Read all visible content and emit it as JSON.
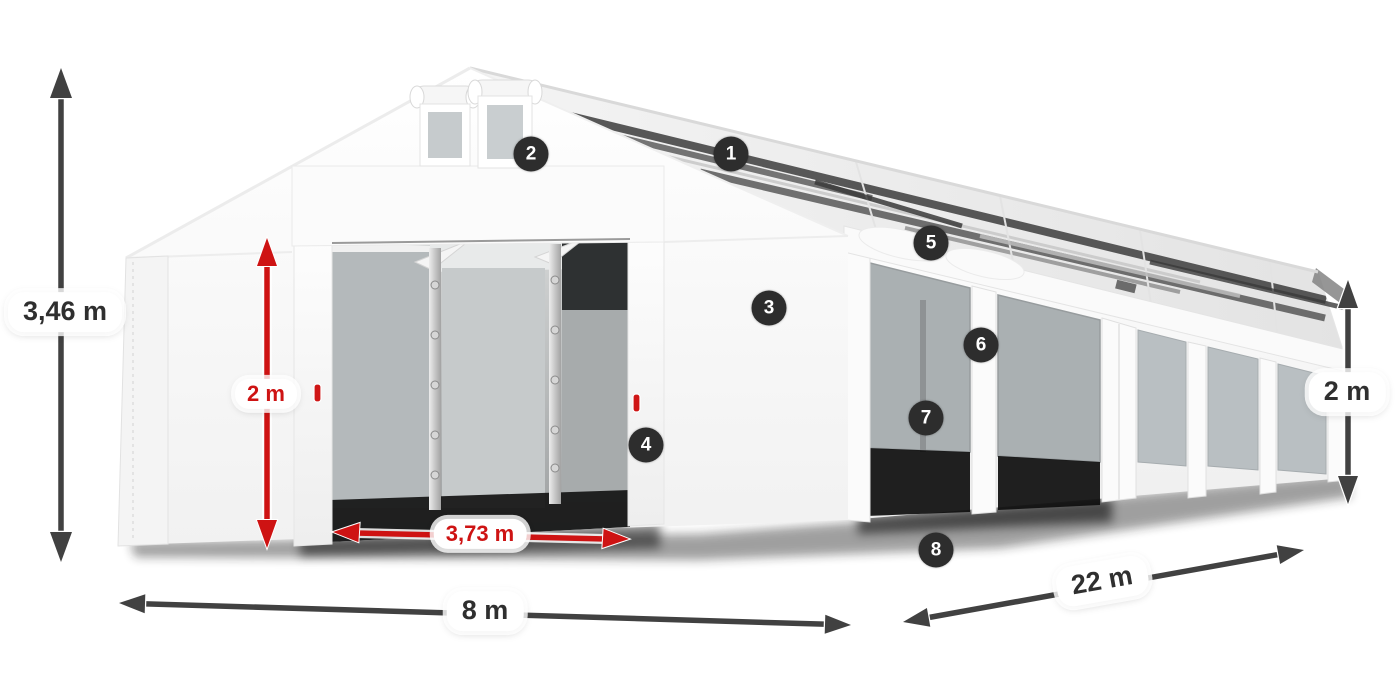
{
  "callouts": [
    {
      "number": "1"
    },
    {
      "number": "2"
    },
    {
      "number": "3"
    },
    {
      "number": "4"
    },
    {
      "number": "5"
    },
    {
      "number": "6"
    },
    {
      "number": "7"
    },
    {
      "number": "8"
    }
  ],
  "dimensions": {
    "total_height": {
      "label": "3,46 m"
    },
    "door_height": {
      "label": "2 m"
    },
    "door_width": {
      "label": "3,73 m"
    },
    "front_width": {
      "label": "8 m"
    },
    "length": {
      "label": "22 m"
    },
    "side_height": {
      "label": "2 m"
    }
  },
  "colors": {
    "dimension_red": "#ce1313",
    "dimension_gray": "#414141",
    "badge_background": "#2d2d2d",
    "label_background": "#ffffff",
    "label_text": "#2f2f2f"
  }
}
